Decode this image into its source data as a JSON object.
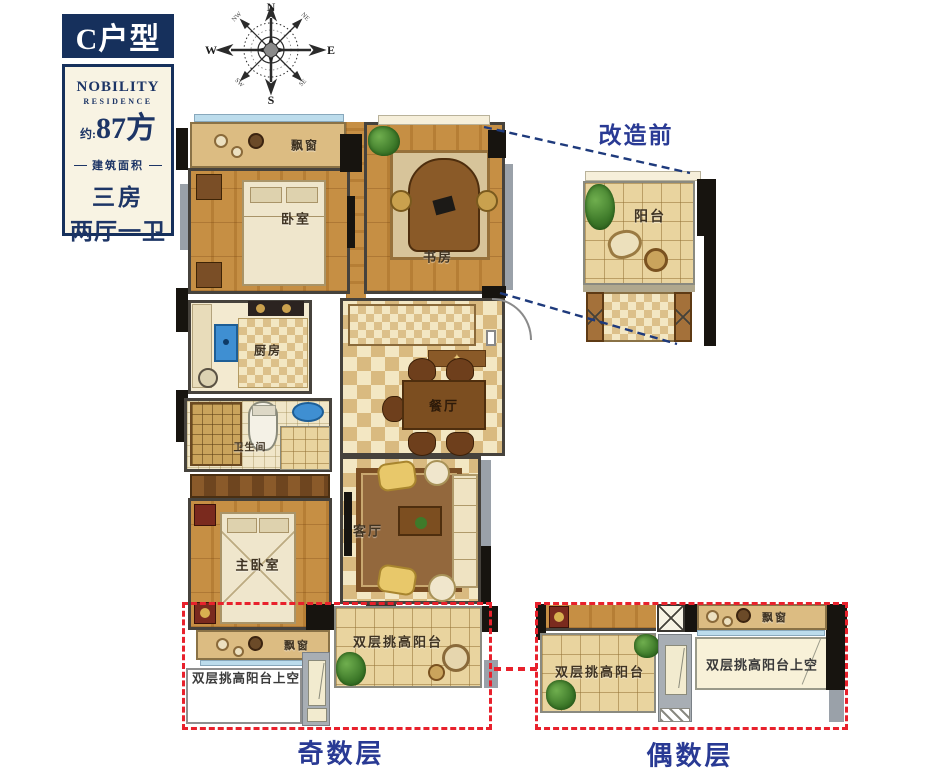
{
  "panel": {
    "unit_type": "C户型",
    "brand_name": "NOBILITY",
    "brand_sub": "RESIDENCE",
    "area_prefix": "约:",
    "area_value": "87方",
    "area_caption": "建筑面积",
    "rooms_line1": "三房",
    "rooms_line2": "两厅一卫"
  },
  "compass": {
    "n": "N",
    "e": "E",
    "s": "S",
    "w": "W",
    "ne": "NE",
    "nw": "NW",
    "se": "SE",
    "sw": "SW"
  },
  "plan": {
    "bay_window_top": "飘窗",
    "bedroom": "卧室",
    "study": "书房",
    "kitchen": "厨房",
    "bathroom": "卫生间",
    "dining": "餐厅",
    "living": "客厅",
    "master_bedroom": "主卧室"
  },
  "before": {
    "title": "改造前",
    "balcony": "阳台"
  },
  "odd": {
    "caption": "奇数层",
    "bay_window": "飘窗",
    "balcony": "双层挑高阳台",
    "void_label": "双层挑高阳台上空"
  },
  "even": {
    "caption": "偶数层",
    "bay_window": "飘窗",
    "balcony": "双层挑高阳台",
    "void_label": "双层挑高阳台上空"
  },
  "colors": {
    "navy": "#16305c",
    "caption_blue": "#293a94",
    "dashed_red": "#e8212c",
    "dashed_navy": "#1e3a7c",
    "wood": "#c68f44",
    "bay_tan": "#dcbc82"
  }
}
